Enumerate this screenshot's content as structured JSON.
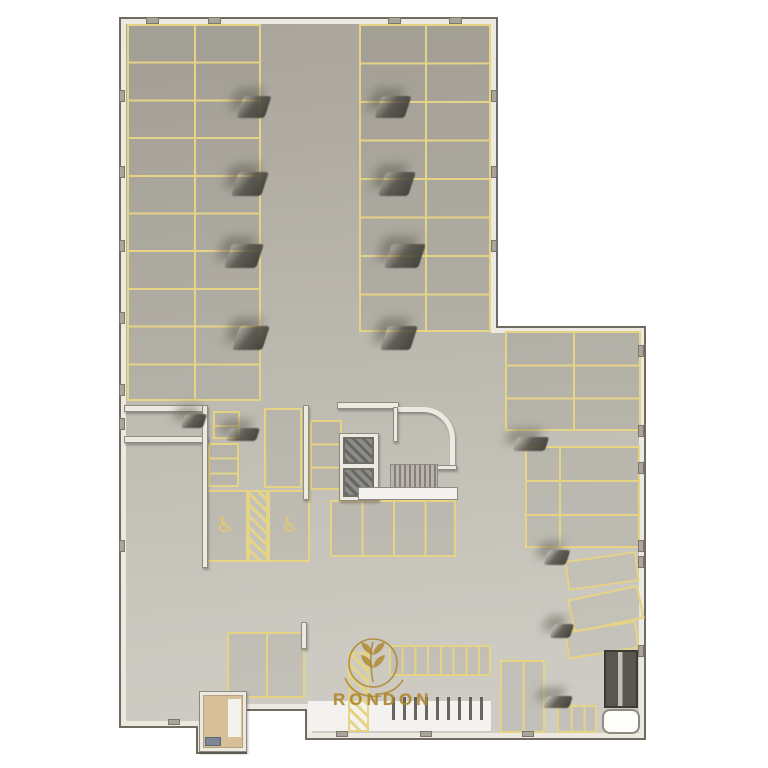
{
  "logo": {
    "text": "RONDON",
    "color": "#ad862c"
  },
  "colors": {
    "parking_line": "#e5d386",
    "wall": "#ece9e0",
    "wall_edge": "#6f6b61",
    "floor_top": "#a8a49b",
    "floor_bottom": "#d0cdc6",
    "white_floor": "#f3f2ee",
    "gold": "#ad862c"
  },
  "symbols": {
    "accessible_parking": "♿"
  },
  "primitives": [
    {
      "n": "building-outline",
      "t": "poly",
      "style": {
        "clipPath": "polygon(119px 17px, 498px 17px, 498px 326px, 646px 326px, 646px 740px, 305px 740px, 305px 711px, 247px 711px, 247px 754px, 196px 754px, 196px 728px, 119px 728px)",
        "background": "#6f6b61",
        "filter": "drop-shadow(10px 14px 12px rgba(80,78,70,0.35))"
      }
    },
    {
      "n": "building-wall-band",
      "t": "poly",
      "style": {
        "clipPath": "polygon(121px 19px, 496px 19px, 496px 328px, 644px 328px, 644px 738px, 307px 738px, 307px 709px, 245px 709px, 245px 752px, 198px 752px, 198px 726px, 121px 726px)",
        "background": "#ece9e0"
      }
    },
    {
      "n": "floor-slab",
      "t": "poly",
      "style": {
        "clipPath": "polygon(126px 24px, 491px 24px, 491px 333px, 639px 333px, 639px 733px, 312px 733px, 312px 704px, 240px 704px, 240px 747px, 203px 747px, 203px 721px, 126px 721px)",
        "background": "linear-gradient(175deg, #a8a49b 0%, #b2aea5 25%, #c0bdb4 55%, #ccc9c1 80%, #d0cdc6 100%)"
      }
    },
    {
      "n": "entrance-white-floor",
      "t": "whitefloor",
      "x": 308,
      "y": 701,
      "w": 183,
      "h": 30
    },
    {
      "n": "parking-grid-left",
      "t": "grid",
      "x": 127,
      "y": 24,
      "w": 134,
      "h": 377,
      "cols": 2,
      "rows": 10
    },
    {
      "n": "parking-grid-right",
      "t": "grid",
      "x": 359,
      "y": 24,
      "w": 132,
      "h": 308,
      "cols": 2,
      "rows": 8
    },
    {
      "n": "parking-grid-southeast",
      "t": "grid",
      "x": 505,
      "y": 331,
      "w": 136,
      "h": 100,
      "cols": 2,
      "rows": 3
    },
    {
      "n": "parking-group-east",
      "t": "grid",
      "x": 525,
      "y": 446,
      "w": 115,
      "h": 102,
      "rows": 3
    },
    {
      "n": "parking-group-east-divider",
      "t": "prim",
      "x": 559,
      "y": 446,
      "w": 2,
      "h": 102,
      "style": {
        "background": "#e5d386"
      }
    },
    {
      "n": "moto-stack-upper",
      "t": "grid",
      "x": 213,
      "y": 411,
      "w": 27,
      "h": 28,
      "rows": 2
    },
    {
      "n": "moto-stack-lower",
      "t": "grid",
      "x": 208,
      "y": 443,
      "w": 31,
      "h": 44,
      "rows": 3
    },
    {
      "n": "stall-large-vertical",
      "t": "rect",
      "x": 264,
      "y": 408,
      "w": 38,
      "h": 80
    },
    {
      "n": "moto-stack-core-left",
      "t": "grid",
      "x": 310,
      "y": 420,
      "w": 32,
      "h": 70,
      "rows": 3
    },
    {
      "n": "stalls-below-core",
      "t": "grid",
      "x": 330,
      "y": 500,
      "w": 126,
      "h": 57,
      "cols": 4
    },
    {
      "n": "accessible-stall-left",
      "t": "rect",
      "x": 203,
      "y": 490,
      "w": 45,
      "h": 72
    },
    {
      "n": "accessible-stall-right",
      "t": "rect",
      "x": 268,
      "y": 490,
      "w": 42,
      "h": 72
    },
    {
      "n": "accessible-hatch-stripe",
      "t": "hatch",
      "x": 248,
      "y": 490,
      "w": 20,
      "h": 72
    },
    {
      "n": "accessible-icon",
      "t": "sym",
      "x": 210,
      "y": 515,
      "w": 30,
      "h": 24,
      "text": "♿",
      "fs": 21
    },
    {
      "n": "accessible-icon",
      "t": "sym",
      "x": 275,
      "y": 515,
      "w": 30,
      "h": 24,
      "text": "♿",
      "fs": 21
    },
    {
      "n": "stalls-lower-left",
      "t": "grid",
      "x": 227,
      "y": 632,
      "w": 78,
      "h": 66,
      "cols": 2
    },
    {
      "n": "bike-stall-row",
      "t": "grid",
      "x": 389,
      "y": 645,
      "w": 102,
      "h": 31,
      "cols": 8
    },
    {
      "n": "stall-pair-south",
      "t": "grid",
      "x": 500,
      "y": 660,
      "w": 45,
      "h": 73,
      "cols": 2
    },
    {
      "n": "moto-stalls-south",
      "t": "grid",
      "x": 557,
      "y": 705,
      "w": 40,
      "h": 28,
      "cols": 3
    },
    {
      "n": "angled-stall",
      "t": "rect",
      "x": 566,
      "y": 556,
      "w": 72,
      "h": 30,
      "rot": -8
    },
    {
      "n": "angled-stall",
      "t": "rect",
      "x": 570,
      "y": 592,
      "w": 72,
      "h": 34,
      "rot": -12
    },
    {
      "n": "angled-stall",
      "t": "rect",
      "x": 566,
      "y": 626,
      "w": 72,
      "h": 28,
      "rot": -9
    },
    {
      "n": "pedestrian-hatch-crossing",
      "t": "hatch",
      "x": 348,
      "y": 652,
      "w": 21,
      "h": 80
    },
    {
      "n": "ramp-wall-top",
      "t": "wall",
      "x": 124,
      "y": 405,
      "w": 82,
      "h": 7
    },
    {
      "n": "ramp-wall-mid",
      "t": "wall",
      "x": 124,
      "y": 436,
      "w": 84,
      "h": 7
    },
    {
      "n": "ramp-wall-right",
      "t": "wall",
      "x": 202,
      "y": 405,
      "w": 6,
      "h": 163
    },
    {
      "n": "core-wall-top",
      "t": "wall",
      "x": 337,
      "y": 402,
      "w": 62,
      "h": 7
    },
    {
      "n": "core-curved-wall",
      "t": "curve",
      "x": 397,
      "y": 407,
      "w": 58,
      "h": 60
    },
    {
      "n": "core-wall-left-upper",
      "t": "wall",
      "x": 393,
      "y": 407,
      "w": 5,
      "h": 35
    },
    {
      "n": "core-wall-bottom",
      "t": "wall",
      "x": 390,
      "y": 465,
      "w": 67,
      "h": 5
    },
    {
      "n": "elevator-shaft-walls",
      "t": "wall",
      "x": 339,
      "y": 433,
      "w": 40,
      "h": 68
    },
    {
      "n": "elevator-cab-floor",
      "t": "darkhatch",
      "x": 343,
      "y": 437,
      "w": 31,
      "h": 27
    },
    {
      "n": "elevator-cab-floor",
      "t": "darkhatch",
      "x": 343,
      "y": 468,
      "w": 31,
      "h": 29
    },
    {
      "n": "stair-landing-strip",
      "t": "whitefloor",
      "x": 358,
      "y": 487,
      "w": 100,
      "h": 13,
      "style": {
        "border": "1px solid #8f8b82"
      }
    },
    {
      "n": "stair-treads",
      "t": "treads",
      "x": 390,
      "y": 464,
      "w": 48,
      "h": 24
    },
    {
      "n": "core-separation-wall",
      "t": "wall",
      "x": 303,
      "y": 405,
      "w": 6,
      "h": 95
    },
    {
      "n": "wall-stub-lower-left",
      "t": "wall",
      "x": 301,
      "y": 622,
      "w": 6,
      "h": 27
    },
    {
      "n": "wall-shadow-segment",
      "t": "wedge",
      "x": 228,
      "y": 428,
      "w": 30,
      "h": 13
    },
    {
      "n": "utility-room-walls",
      "t": "wall",
      "x": 199,
      "y": 691,
      "w": 48,
      "h": 61
    },
    {
      "n": "utility-room-floor",
      "t": "tanfloor",
      "x": 203,
      "y": 695,
      "w": 40,
      "h": 53
    },
    {
      "n": "utility-room-white-strip",
      "t": "whitefloor",
      "x": 228,
      "y": 699,
      "w": 13,
      "h": 38
    },
    {
      "n": "utility-room-equipment",
      "t": "bluebox",
      "x": 205,
      "y": 737,
      "w": 16,
      "h": 9
    },
    {
      "n": "bike-racks",
      "t": "racks",
      "x": 392,
      "y": 697,
      "w": 92,
      "h": 23
    },
    {
      "n": "exit-ramp-dark",
      "t": "rampdark",
      "x": 604,
      "y": 650,
      "w": 34,
      "h": 58
    },
    {
      "n": "white-room-southeast",
      "t": "whiteroom",
      "x": 602,
      "y": 709,
      "w": 38,
      "h": 25
    },
    {
      "n": "column-shadow",
      "t": "wedge",
      "x": 240,
      "y": 96,
      "w": 28,
      "h": 22
    },
    {
      "n": "column-shadow",
      "t": "wedge",
      "x": 235,
      "y": 172,
      "w": 30,
      "h": 24
    },
    {
      "n": "column-shadow",
      "t": "wedge",
      "x": 228,
      "y": 244,
      "w": 32,
      "h": 24
    },
    {
      "n": "column-shadow",
      "t": "wedge",
      "x": 236,
      "y": 326,
      "w": 30,
      "h": 24
    },
    {
      "n": "column-shadow",
      "t": "wedge",
      "x": 378,
      "y": 96,
      "w": 30,
      "h": 22
    },
    {
      "n": "column-shadow",
      "t": "wedge",
      "x": 382,
      "y": 172,
      "w": 30,
      "h": 24
    },
    {
      "n": "column-shadow",
      "t": "wedge",
      "x": 388,
      "y": 244,
      "w": 34,
      "h": 24
    },
    {
      "n": "column-shadow",
      "t": "wedge",
      "x": 384,
      "y": 326,
      "w": 30,
      "h": 24
    },
    {
      "n": "column-shadow",
      "t": "wedge",
      "x": 515,
      "y": 437,
      "w": 32,
      "h": 14
    },
    {
      "n": "column-shadow",
      "t": "wedge",
      "x": 546,
      "y": 550,
      "w": 22,
      "h": 15
    },
    {
      "n": "column-shadow",
      "t": "wedge",
      "x": 552,
      "y": 624,
      "w": 20,
      "h": 14
    },
    {
      "n": "column-shadow",
      "t": "wedge",
      "x": 545,
      "y": 696,
      "w": 26,
      "h": 12
    },
    {
      "n": "column-shadow",
      "t": "wedge",
      "x": 183,
      "y": 414,
      "w": 22,
      "h": 14
    },
    {
      "n": "wall-column-tick",
      "t": "nub",
      "x": 146,
      "y": 17,
      "w": 13,
      "h": 7
    },
    {
      "n": "wall-column-tick",
      "t": "nub",
      "x": 208,
      "y": 17,
      "w": 13,
      "h": 7
    },
    {
      "n": "wall-column-tick",
      "t": "nub",
      "x": 388,
      "y": 17,
      "w": 13,
      "h": 7
    },
    {
      "n": "wall-column-tick",
      "t": "nub",
      "x": 449,
      "y": 17,
      "w": 13,
      "h": 7
    },
    {
      "n": "wall-column-tick",
      "t": "nub",
      "x": 119,
      "y": 90,
      "w": 6,
      "h": 12
    },
    {
      "n": "wall-column-tick",
      "t": "nub",
      "x": 119,
      "y": 166,
      "w": 6,
      "h": 12
    },
    {
      "n": "wall-column-tick",
      "t": "nub",
      "x": 119,
      "y": 240,
      "w": 6,
      "h": 12
    },
    {
      "n": "wall-column-tick",
      "t": "nub",
      "x": 119,
      "y": 312,
      "w": 6,
      "h": 12
    },
    {
      "n": "wall-column-tick",
      "t": "nub",
      "x": 119,
      "y": 384,
      "w": 6,
      "h": 12
    },
    {
      "n": "wall-column-tick",
      "t": "nub",
      "x": 119,
      "y": 418,
      "w": 6,
      "h": 12
    },
    {
      "n": "wall-column-tick",
      "t": "nub",
      "x": 119,
      "y": 540,
      "w": 6,
      "h": 12
    },
    {
      "n": "wall-column-tick",
      "t": "nub",
      "x": 491,
      "y": 90,
      "w": 6,
      "h": 12
    },
    {
      "n": "wall-column-tick",
      "t": "nub",
      "x": 491,
      "y": 166,
      "w": 6,
      "h": 12
    },
    {
      "n": "wall-column-tick",
      "t": "nub",
      "x": 491,
      "y": 240,
      "w": 6,
      "h": 12
    },
    {
      "n": "wall-column-tick",
      "t": "nub",
      "x": 638,
      "y": 345,
      "w": 6,
      "h": 12
    },
    {
      "n": "wall-column-tick",
      "t": "nub",
      "x": 638,
      "y": 425,
      "w": 6,
      "h": 12
    },
    {
      "n": "wall-column-tick",
      "t": "nub",
      "x": 638,
      "y": 462,
      "w": 6,
      "h": 12
    },
    {
      "n": "wall-column-tick",
      "t": "nub",
      "x": 638,
      "y": 540,
      "w": 6,
      "h": 12
    },
    {
      "n": "wall-column-tick",
      "t": "nub",
      "x": 638,
      "y": 556,
      "w": 6,
      "h": 12
    },
    {
      "n": "wall-column-tick",
      "t": "nub",
      "x": 638,
      "y": 645,
      "w": 6,
      "h": 12
    },
    {
      "n": "wall-column-tick",
      "t": "nub",
      "x": 336,
      "y": 731,
      "w": 12,
      "h": 6
    },
    {
      "n": "wall-column-tick",
      "t": "nub",
      "x": 420,
      "y": 731,
      "w": 12,
      "h": 6
    },
    {
      "n": "wall-column-tick",
      "t": "nub",
      "x": 522,
      "y": 731,
      "w": 12,
      "h": 6
    },
    {
      "n": "wall-column-tick",
      "t": "nub",
      "x": 168,
      "y": 719,
      "w": 12,
      "h": 6
    }
  ]
}
